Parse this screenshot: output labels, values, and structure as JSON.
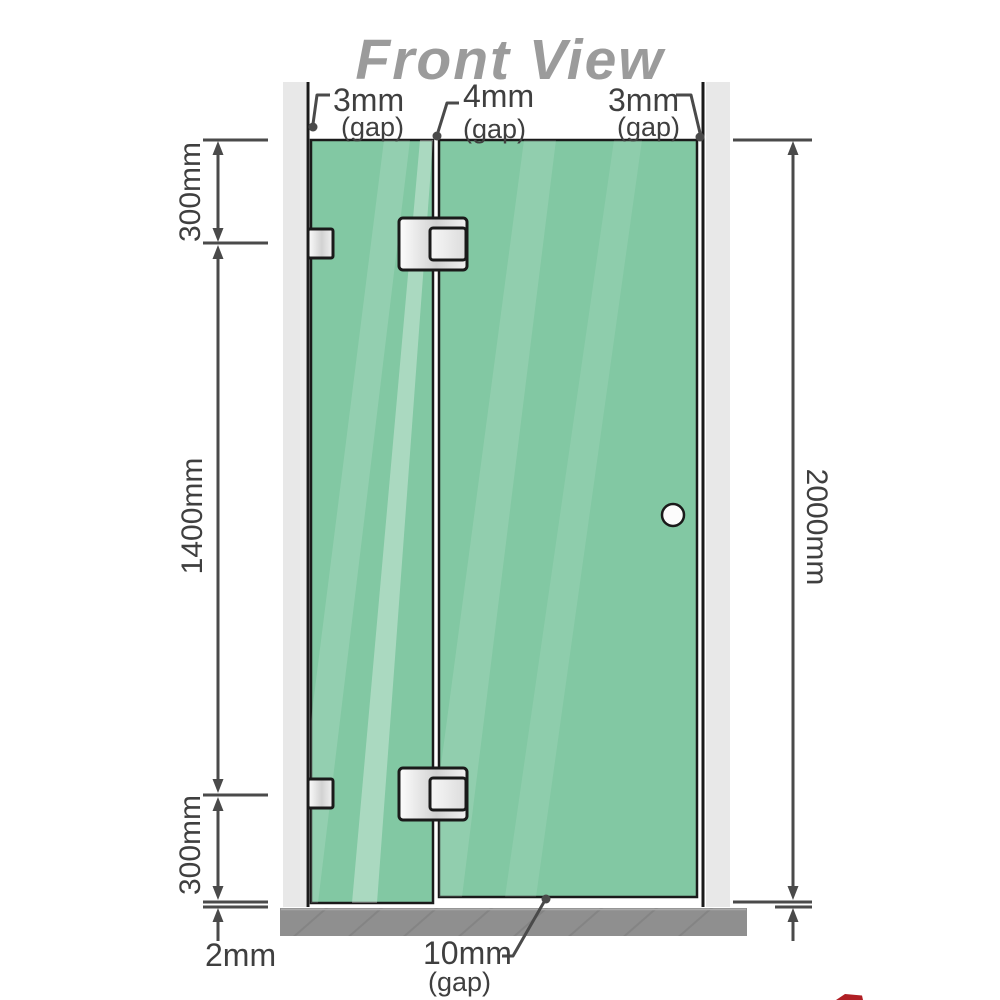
{
  "title": "Front View",
  "annotations": {
    "gap_left": {
      "value": "3mm",
      "suffix": "(gap)"
    },
    "gap_middle": {
      "value": "4mm",
      "suffix": "(gap)"
    },
    "gap_right": {
      "value": "3mm",
      "suffix": "(gap)"
    },
    "gap_bottom": {
      "value": "10mm",
      "suffix": "(gap)"
    },
    "seg_top": "300mm",
    "seg_middle": "1400mm",
    "seg_bottom": "300mm",
    "floor_gap": "2mm",
    "total_height": "2000mm"
  },
  "components": {
    "left_wall": "wall",
    "right_wall": "wall",
    "floor": "floor base",
    "fixed_panel": "fixed glass panel",
    "door_panel": "hinged glass door",
    "hinge_top": "glass-to-glass hinge",
    "hinge_bottom": "glass-to-glass hinge",
    "bracket_top": "wall bracket",
    "bracket_bottom": "wall bracket",
    "handle": "door knob"
  },
  "colors": {
    "glass": "#82c8a3",
    "wall": "#e8e8e8",
    "floor": "#8f8f8f",
    "floor_hatch": "#7c7c7c",
    "line": "#4a4a4a",
    "outline": "#1a1a1a",
    "text": "#3f3f3f",
    "title": "#9b9b9b",
    "logo_red": "#b01f24"
  }
}
